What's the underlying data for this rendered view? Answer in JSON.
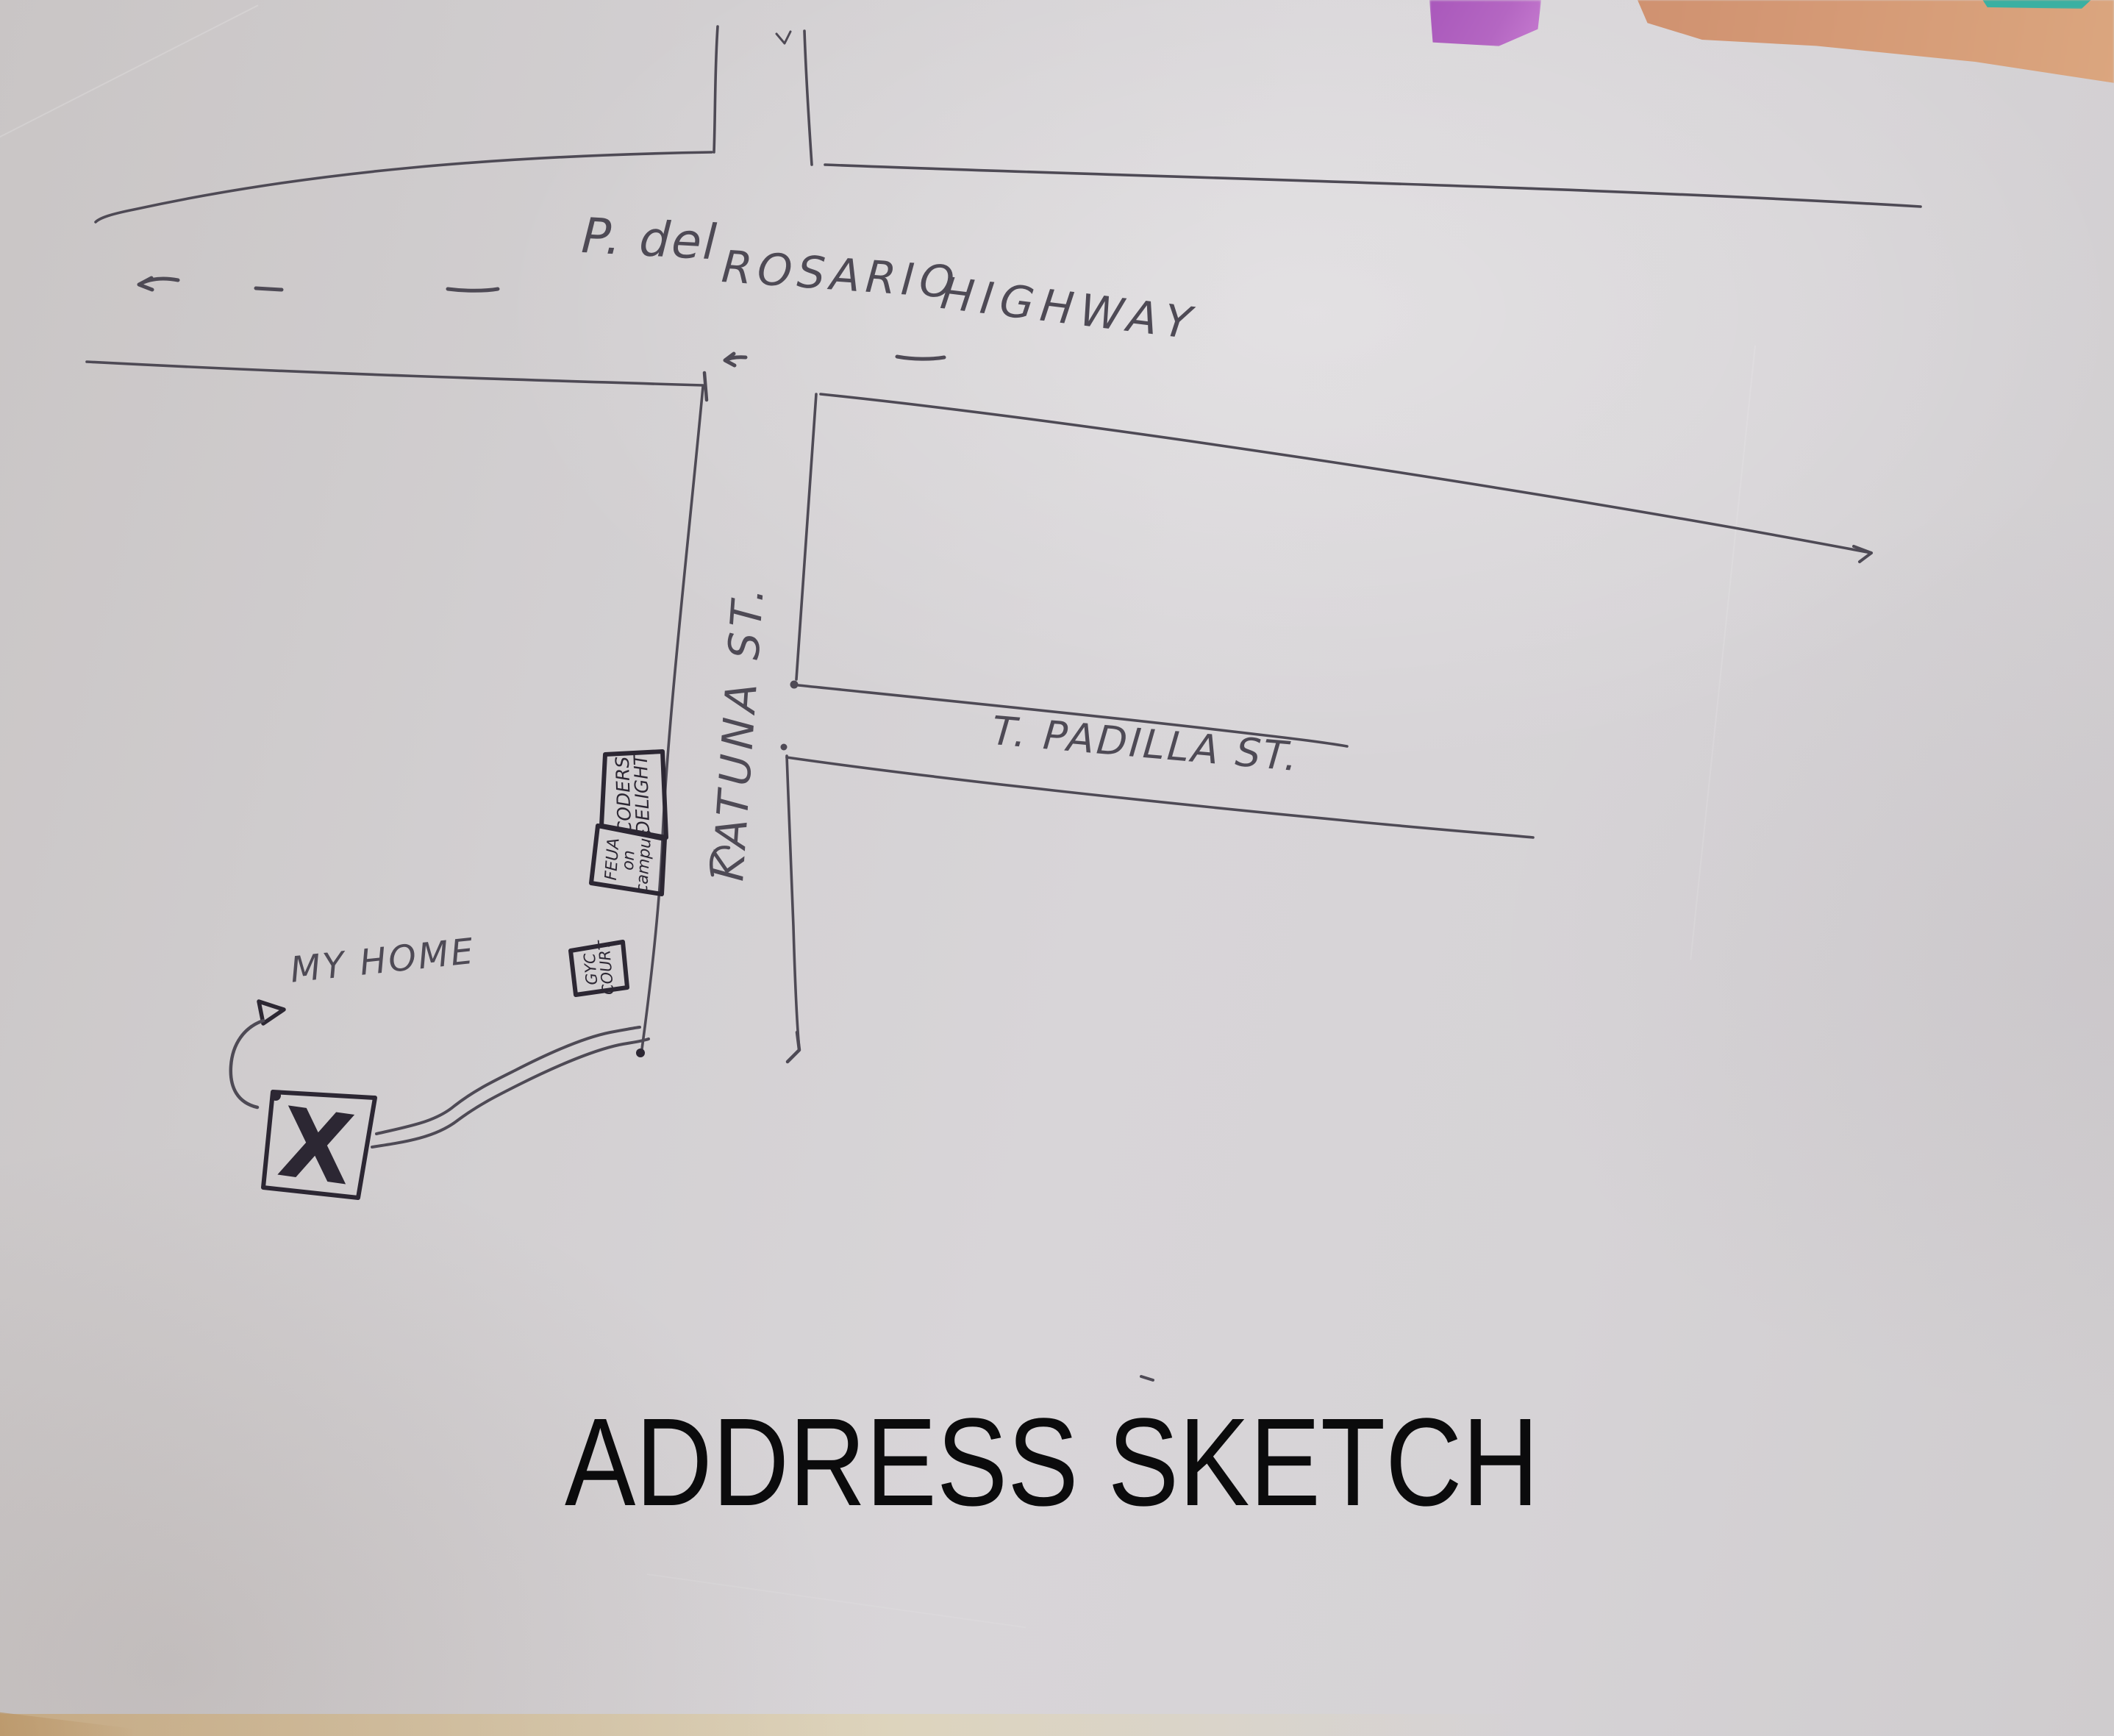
{
  "title": "ADDRESS SKETCH",
  "labels": {
    "highway_part1": "P. del",
    "highway_part2": "ROSARIO",
    "highway_part3": "HIGHWAY",
    "katuna_street": "KATUNA ST.",
    "padilla_street": "T. PADILLA ST.",
    "my_home": "MY HOME"
  },
  "landmarks": {
    "shop_box": {
      "line1": "CODERS",
      "line2": "DELIGHT"
    },
    "campus_box": {
      "line1": "FEUA",
      "line2": "on",
      "line3": "campus"
    },
    "court_box": {
      "line1": "GYC",
      "line2": "COURT"
    },
    "home_marker": "X"
  },
  "colors": {
    "paper": "#d3d0d2",
    "ink": "#4e4a55",
    "marker": "#2c2733",
    "title_text": "#0b0b0c",
    "patch_purple": "#b466c2",
    "patch_orange": "#d59a76",
    "patch_teal": "#3ab0a2",
    "bottom_strip": "#e0d3ae"
  }
}
